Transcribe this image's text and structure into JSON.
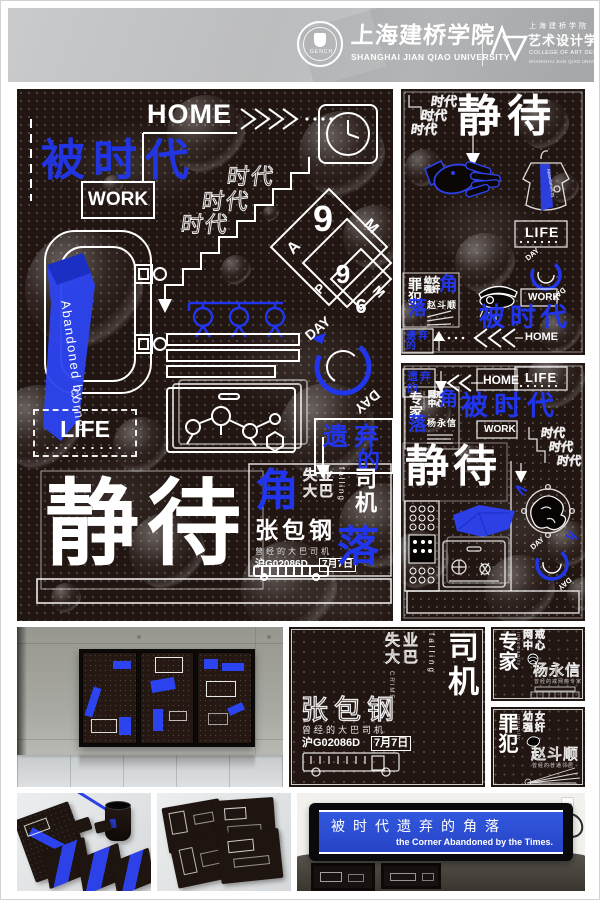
{
  "header": {
    "seal_text": "GENCH",
    "university_cn": "上海建桥学院",
    "university_en": "SHANGHAI JIAN QIAO UNIVERSITY",
    "college_cn_top": "上海建桥学院",
    "college_cn": "艺术设计学院",
    "college_en": "COLLEGE OF ART DESIGN",
    "college_en_sub": "SHANGHAI JIAN QIAO UNIVERSITY"
  },
  "labels": {
    "home": "HOME",
    "work": "WORK",
    "life": "LIFE",
    "day": "DAY",
    "era_blue": "被时代",
    "era_outline": "时代",
    "waiting": "静待",
    "jiao": "角",
    "luo": "落",
    "abandoned_row1": "遗弃",
    "abandoned_row2": "的",
    "ribbon_line1": "Abandoned by",
    "ribbon_line2": "corner"
  },
  "time_diamond": {
    "outer_hour": "9",
    "outer_a": "A",
    "outer_m": "M",
    "mid_hour": "9",
    "mid_p": "P",
    "mid_m": "M",
    "inner_hour": "6"
  },
  "driver": {
    "tag_row1": "失业",
    "tag_row2": "大巴",
    "falling": "falling",
    "crime": "CRIME",
    "role": "司机",
    "name": "张包钢",
    "subtitle": "曾经的大巴司机",
    "plate": "沪G02086D",
    "date": "7月7日"
  },
  "expert": {
    "tag": "专家",
    "en_vertical": "inhumanity",
    "topic_row1": "网戒",
    "topic_row2": "中心",
    "name": "杨永信",
    "subtitle": "曾经的戒网瘾专家"
  },
  "criminal": {
    "tag": "罪犯",
    "en_vertical": "impunity",
    "topic_row1": "幼女",
    "topic_row2": "强奸",
    "name": "赵斗顺",
    "subtitle": "曾经的普通邻居"
  },
  "led": {
    "cn": "被时代遗弃的角落",
    "en": "the Corner Abandoned by the Times."
  },
  "colors": {
    "accent_blue": "#2136ec",
    "poster_bg": "#221612",
    "led_screen": "#2b4fd8"
  }
}
